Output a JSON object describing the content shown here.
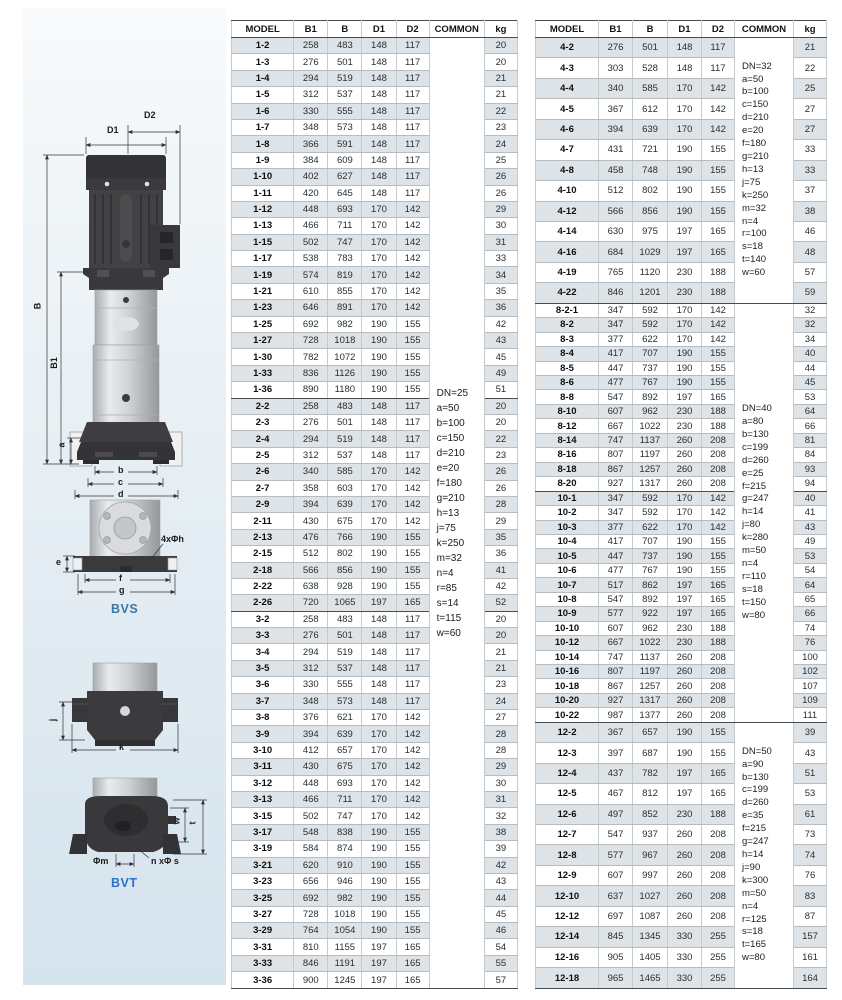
{
  "illustration": {
    "pump": {
      "d2": "D2",
      "d1": "D1",
      "b_total": "B",
      "b1": "B1",
      "a": "a",
      "b": "b",
      "c": "c",
      "d": "d"
    },
    "bvs": {
      "title": "BVS",
      "bolt_holes": "4xΦh",
      "e": "e",
      "f": "f",
      "g": "g"
    },
    "side": {
      "j": "j",
      "k": "k"
    },
    "bvt": {
      "title": "BVT",
      "phi_m": "Φm",
      "n_phi_s": "n xΦ s",
      "w": "w",
      "t": "t"
    }
  },
  "tables": [
    {
      "headers": [
        "MODEL",
        "B1",
        "B",
        "D1",
        "D2",
        "COMMON",
        "kg"
      ],
      "commons": [
        {
          "start": 0,
          "span": 58,
          "lines": [
            "DN=25",
            "a=50",
            "b=100",
            "c=150",
            "d=210",
            "e=20",
            "f=180",
            "g=210",
            "h=13",
            "j=75",
            "k=250",
            "m=32",
            "n=4",
            "r=85",
            "s=14",
            "t=115",
            "w=60"
          ]
        }
      ],
      "groups": [
        {
          "rows": [
            [
              "1-2",
              258,
              483,
              148,
              117,
              20
            ],
            [
              "1-3",
              276,
              501,
              148,
              117,
              20
            ],
            [
              "1-4",
              294,
              519,
              148,
              117,
              21
            ],
            [
              "1-5",
              312,
              537,
              148,
              117,
              21
            ],
            [
              "1-6",
              330,
              555,
              148,
              117,
              22
            ],
            [
              "1-7",
              348,
              573,
              148,
              117,
              23
            ],
            [
              "1-8",
              366,
              591,
              148,
              117,
              24
            ],
            [
              "1-9",
              384,
              609,
              148,
              117,
              25
            ],
            [
              "1-10",
              402,
              627,
              148,
              117,
              26
            ],
            [
              "1-11",
              420,
              645,
              148,
              117,
              26
            ],
            [
              "1-12",
              448,
              693,
              170,
              142,
              29
            ],
            [
              "1-13",
              466,
              711,
              170,
              142,
              30
            ],
            [
              "1-15",
              502,
              747,
              170,
              142,
              31
            ],
            [
              "1-17",
              538,
              783,
              170,
              142,
              33
            ],
            [
              "1-19",
              574,
              819,
              170,
              142,
              34
            ],
            [
              "1-21",
              610,
              855,
              170,
              142,
              35
            ],
            [
              "1-23",
              646,
              891,
              170,
              142,
              36
            ],
            [
              "1-25",
              692,
              982,
              190,
              155,
              42
            ],
            [
              "1-27",
              728,
              1018,
              190,
              155,
              43
            ],
            [
              "1-30",
              782,
              1072,
              190,
              155,
              45
            ],
            [
              "1-33",
              836,
              1126,
              190,
              155,
              49
            ],
            [
              "1-36",
              890,
              1180,
              190,
              155,
              51
            ]
          ]
        },
        {
          "rows": [
            [
              "2-2",
              258,
              483,
              148,
              117,
              20
            ],
            [
              "2-3",
              276,
              501,
              148,
              117,
              20
            ],
            [
              "2-4",
              294,
              519,
              148,
              117,
              22
            ],
            [
              "2-5",
              312,
              537,
              148,
              117,
              23
            ],
            [
              "2-6",
              340,
              585,
              170,
              142,
              26
            ],
            [
              "2-7",
              358,
              603,
              170,
              142,
              26
            ],
            [
              "2-9",
              394,
              639,
              170,
              142,
              28
            ],
            [
              "2-11",
              430,
              675,
              170,
              142,
              29
            ],
            [
              "2-13",
              476,
              766,
              190,
              155,
              35
            ],
            [
              "2-15",
              512,
              802,
              190,
              155,
              36
            ],
            [
              "2-18",
              566,
              856,
              190,
              155,
              41
            ],
            [
              "2-22",
              638,
              928,
              190,
              155,
              42
            ],
            [
              "2-26",
              720,
              1065,
              197,
              165,
              52
            ]
          ]
        },
        {
          "rows": [
            [
              "3-2",
              258,
              483,
              148,
              117,
              20
            ],
            [
              "3-3",
              276,
              501,
              148,
              117,
              20
            ],
            [
              "3-4",
              294,
              519,
              148,
              117,
              21
            ],
            [
              "3-5",
              312,
              537,
              148,
              117,
              21
            ],
            [
              "3-6",
              330,
              555,
              148,
              117,
              23
            ],
            [
              "3-7",
              348,
              573,
              148,
              117,
              24
            ],
            [
              "3-8",
              376,
              621,
              170,
              142,
              27
            ],
            [
              "3-9",
              394,
              639,
              170,
              142,
              28
            ],
            [
              "3-10",
              412,
              657,
              170,
              142,
              28
            ],
            [
              "3-11",
              430,
              675,
              170,
              142,
              29
            ],
            [
              "3-12",
              448,
              693,
              170,
              142,
              30
            ],
            [
              "3-13",
              466,
              711,
              170,
              142,
              31
            ],
            [
              "3-15",
              502,
              747,
              170,
              142,
              32
            ],
            [
              "3-17",
              548,
              838,
              190,
              155,
              38
            ],
            [
              "3-19",
              584,
              874,
              190,
              155,
              39
            ],
            [
              "3-21",
              620,
              910,
              190,
              155,
              42
            ],
            [
              "3-23",
              656,
              946,
              190,
              155,
              43
            ],
            [
              "3-25",
              692,
              982,
              190,
              155,
              44
            ],
            [
              "3-27",
              728,
              1018,
              190,
              155,
              45
            ],
            [
              "3-29",
              764,
              1054,
              190,
              155,
              46
            ],
            [
              "3-31",
              810,
              1155,
              197,
              165,
              54
            ],
            [
              "3-33",
              846,
              1191,
              197,
              165,
              55
            ],
            [
              "3-36",
              900,
              1245,
              197,
              165,
              57
            ]
          ]
        }
      ]
    },
    {
      "headers": [
        "MODEL",
        "B1",
        "B",
        "D1",
        "D2",
        "COMMON",
        "kg"
      ],
      "commons": [
        {
          "start": 0,
          "span": 13,
          "lines": [
            "DN=32",
            "a=50",
            "b=100",
            "c=150",
            "d=210",
            "e=20",
            "f=180",
            "g=210",
            "h=13",
            "j=75",
            "k=250",
            "m=32",
            "n=4",
            "r=100",
            "s=18",
            "t=140",
            "w=60"
          ]
        },
        {
          "start": 13,
          "span": 29,
          "lines": [
            "DN=40",
            "a=80",
            "b=130",
            "c=199",
            "d=260",
            "e=25",
            "f=215",
            "g=247",
            "h=14",
            "j=80",
            "k=280",
            "m=50",
            "n=4",
            "r=110",
            "s=18",
            "t=150",
            "w=80"
          ]
        },
        {
          "start": 42,
          "span": 13,
          "lines": [
            "DN=50",
            "a=90",
            "b=130",
            "c=199",
            "d=260",
            "e=35",
            "f=215",
            "g=247",
            "h=14",
            "j=90",
            "k=300",
            "m=50",
            "n=4",
            "r=125",
            "s=18",
            "t=165",
            "w=80"
          ]
        }
      ],
      "groups": [
        {
          "rows": [
            [
              "4-2",
              276,
              501,
              148,
              117,
              21
            ],
            [
              "4-3",
              303,
              528,
              148,
              117,
              22
            ],
            [
              "4-4",
              340,
              585,
              170,
              142,
              25
            ],
            [
              "4-5",
              367,
              612,
              170,
              142,
              27
            ],
            [
              "4-6",
              394,
              639,
              170,
              142,
              27
            ],
            [
              "4-7",
              431,
              721,
              190,
              155,
              33
            ],
            [
              "4-8",
              458,
              748,
              190,
              155,
              33
            ],
            [
              "4-10",
              512,
              802,
              190,
              155,
              37
            ],
            [
              "4-12",
              566,
              856,
              190,
              155,
              38
            ],
            [
              "4-14",
              630,
              975,
              197,
              165,
              46
            ],
            [
              "4-16",
              684,
              1029,
              197,
              165,
              48
            ],
            [
              "4-19",
              765,
              1120,
              230,
              188,
              57
            ],
            [
              "4-22",
              846,
              1201,
              230,
              188,
              59
            ]
          ]
        },
        {
          "rows": [
            [
              "8-2-1",
              347,
              592,
              170,
              142,
              32
            ],
            [
              "8-2",
              347,
              592,
              170,
              142,
              32
            ],
            [
              "8-3",
              377,
              622,
              170,
              142,
              34
            ],
            [
              "8-4",
              417,
              707,
              190,
              155,
              40
            ],
            [
              "8-5",
              447,
              737,
              190,
              155,
              44
            ],
            [
              "8-6",
              477,
              767,
              190,
              155,
              45
            ],
            [
              "8-8",
              547,
              892,
              197,
              165,
              53
            ],
            [
              "8-10",
              607,
              962,
              230,
              188,
              64
            ],
            [
              "8-12",
              667,
              1022,
              230,
              188,
              66
            ],
            [
              "8-14",
              747,
              1137,
              260,
              208,
              81
            ],
            [
              "8-16",
              807,
              1197,
              260,
              208,
              84
            ],
            [
              "8-18",
              867,
              1257,
              260,
              208,
              93
            ],
            [
              "8-20",
              927,
              1317,
              260,
              208,
              94
            ]
          ]
        },
        {
          "rows": [
            [
              "10-1",
              347,
              592,
              170,
              142,
              40
            ],
            [
              "10-2",
              347,
              592,
              170,
              142,
              41
            ],
            [
              "10-3",
              377,
              622,
              170,
              142,
              43
            ],
            [
              "10-4",
              417,
              707,
              190,
              155,
              49
            ],
            [
              "10-5",
              447,
              737,
              190,
              155,
              53
            ],
            [
              "10-6",
              477,
              767,
              190,
              155,
              54
            ],
            [
              "10-7",
              517,
              862,
              197,
              165,
              64
            ],
            [
              "10-8",
              547,
              892,
              197,
              165,
              65
            ],
            [
              "10-9",
              577,
              922,
              197,
              165,
              66
            ],
            [
              "10-10",
              607,
              962,
              230,
              188,
              74
            ],
            [
              "10-12",
              667,
              1022,
              230,
              188,
              76
            ],
            [
              "10-14",
              747,
              1137,
              260,
              208,
              100
            ],
            [
              "10-16",
              807,
              1197,
              260,
              208,
              102
            ],
            [
              "10-18",
              867,
              1257,
              260,
              208,
              107
            ],
            [
              "10-20",
              927,
              1317,
              260,
              208,
              109
            ],
            [
              "10-22",
              987,
              1377,
              260,
              208,
              111
            ]
          ]
        },
        {
          "rows": [
            [
              "12-2",
              367,
              657,
              190,
              155,
              39
            ],
            [
              "12-3",
              397,
              687,
              190,
              155,
              43
            ],
            [
              "12-4",
              437,
              782,
              197,
              165,
              51
            ],
            [
              "12-5",
              467,
              812,
              197,
              165,
              53
            ],
            [
              "12-6",
              497,
              852,
              230,
              188,
              61
            ],
            [
              "12-7",
              547,
              937,
              260,
              208,
              73
            ],
            [
              "12-8",
              577,
              967,
              260,
              208,
              74
            ],
            [
              "12-9",
              607,
              997,
              260,
              208,
              76
            ],
            [
              "12-10",
              637,
              1027,
              260,
              208,
              83
            ],
            [
              "12-12",
              697,
              1087,
              260,
              208,
              87
            ],
            [
              "12-14",
              845,
              1345,
              330,
              255,
              157
            ],
            [
              "12-16",
              905,
              1405,
              330,
              255,
              161
            ],
            [
              "12-18",
              965,
              1465,
              330,
              255,
              164
            ]
          ]
        }
      ]
    }
  ]
}
